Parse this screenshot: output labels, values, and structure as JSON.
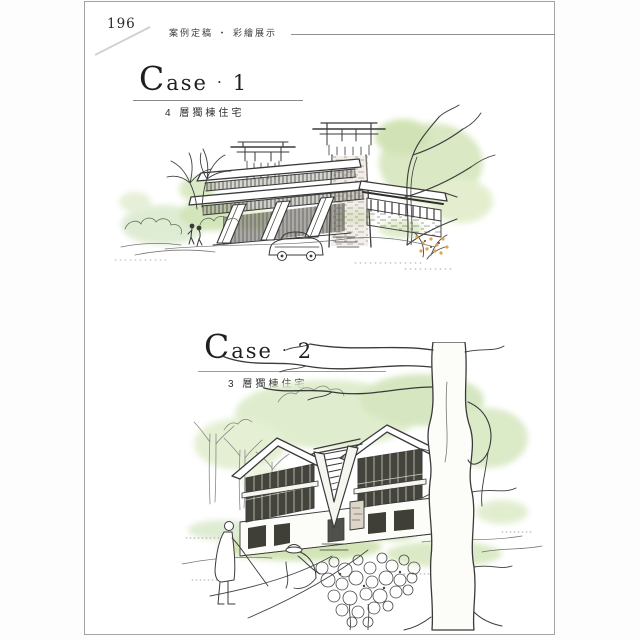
{
  "page": {
    "number": "196"
  },
  "header": {
    "section_title": "案例定稿 ・ 彩繪展示"
  },
  "cases": [
    {
      "initial": "C",
      "rest": "ase",
      "separator": "·",
      "number": "1",
      "subtitle": "4 層獨棟住宅",
      "illustration": "four-storey-detached-house-watercolor-sketch"
    },
    {
      "initial": "C",
      "rest": "ase",
      "separator": "·",
      "number": "2",
      "subtitle": "3 層獨棟住宅",
      "illustration": "three-storey-detached-house-watercolor-sketch"
    }
  ],
  "colors": {
    "ink": "#3a3a3a",
    "wash_green": "#d6e6bd",
    "wash_green_light": "#e3eecd",
    "wash_green_dark": "#c4dca4",
    "accent_orange": "#df9a3e",
    "stone": "#d9d2c4",
    "rule_gray": "#8f8f8f",
    "page_border": "#a3a3a3"
  }
}
